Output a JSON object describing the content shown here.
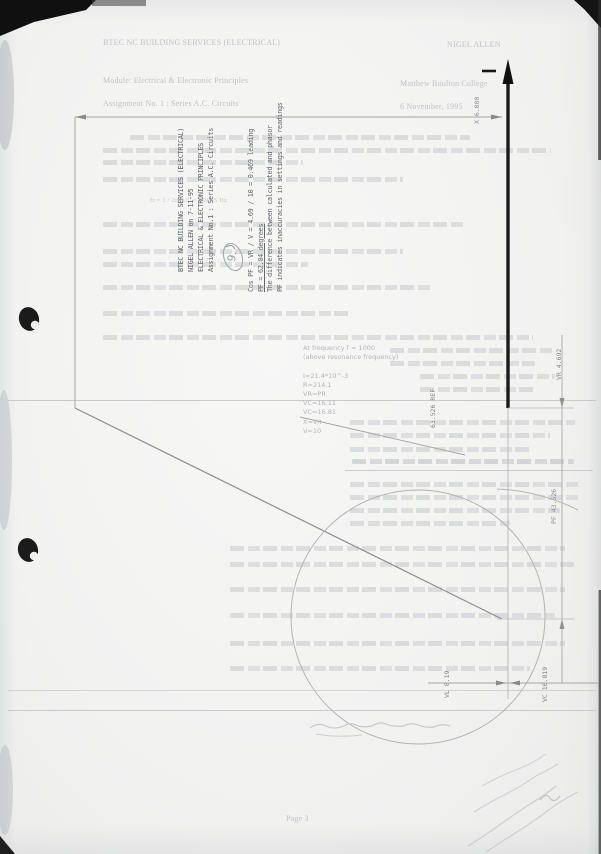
{
  "document_type": "scanned worksheet page with plotted phasor diagram",
  "worksheet": {
    "header_left": "BTEC NC BUILDING SERVICES (ELECTRICAL)",
    "header_right": "NIGEL ALLEN",
    "module_left": "Module: Electrical & Electronic Principles",
    "module_right": "Matthew Boulton College",
    "assignment_left": "Assignment No. 1 : Series A.C. Circuits",
    "assignment_right": "6 November, 1995",
    "formula_fragment": "fr = 1 / 2π√LC  =  1591.5 Hz",
    "footer_page": "Page 3",
    "faint_list": {
      "l0": "At frequency f = 1000",
      "l1": "(above resonance frequency)",
      "l2": "I=21.4*10^-3",
      "l3": "R=214.1",
      "l4": "VR=PR",
      "l5": "VC=16.11",
      "l6": "VC=16.81",
      "l7": "X=V/I",
      "l8": "V=10"
    }
  },
  "diagram": {
    "title_block": {
      "line1": "BTEC NC BUILDING SERVICES (ELECTRICAL)",
      "line2": "NIGEL ALLEN on 7-11-95",
      "line3": "ELECTRICAL & ELECTRONIC PRINCIPLES",
      "line4": "Assignment No.1 : Series A.C. Circuits"
    },
    "note_block": {
      "line1": "Cos PF = VR / V = 4.69 / 10 = 0.469 leading",
      "line2": "PF = 62.04 degrees",
      "line3": "The difference between calculated and phasor",
      "line4": "PF indicates inaccuracies in settings and readings"
    },
    "dimensions": {
      "x_axis": "X 6.000",
      "vr": "VR 4.692",
      "ref": "63.526 REF",
      "pf": "PF 43.526",
      "vl": "VL 8.19",
      "vc": "VC 16.819"
    },
    "handwritten_mark": "9."
  },
  "colors": {
    "paper": "#f2f2f1",
    "faint_print": "#c2c5c8",
    "plot_line": "#8e8e8e",
    "axis_ink": "#161616",
    "scan_black": "#0f0f0f",
    "pencil": "#c6c8ca"
  }
}
